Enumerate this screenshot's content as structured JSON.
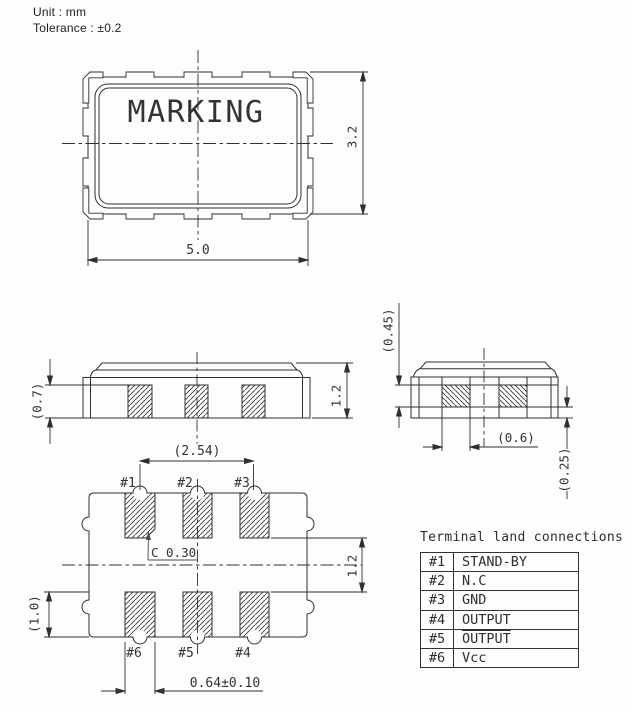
{
  "notes": {
    "unit": "Unit : mm",
    "tolerance": "Tolerance : ±0.2"
  },
  "top_view": {
    "marking": "MARKING",
    "dim_width": "5.0",
    "dim_height": "3.2"
  },
  "front_view": {
    "dim_pad_height": "(0.7)",
    "dim_body_height": "1.2"
  },
  "end_view": {
    "dim_electrode_height": "(0.45)",
    "dim_pad_width": "(0.6)",
    "dim_rim_height": "(0.25)"
  },
  "bottom_view": {
    "dim_pitch": "(2.54)",
    "dim_row_gap": "1.2",
    "dim_pad_length": "(1.0)",
    "chamfer_note": "C 0.30",
    "dim_pad_width": "0.64±0.10",
    "pads": [
      {
        "label": "#1"
      },
      {
        "label": "#2"
      },
      {
        "label": "#3"
      },
      {
        "label": "#4"
      },
      {
        "label": "#5"
      },
      {
        "label": "#6"
      }
    ]
  },
  "table": {
    "title": "Terminal land connections",
    "rows": [
      {
        "pin": "#1",
        "signal": "STAND-BY",
        "overline": false
      },
      {
        "pin": "#2",
        "signal": "N.C",
        "overline": false
      },
      {
        "pin": "#3",
        "signal": "GND",
        "overline": false
      },
      {
        "pin": "#4",
        "signal": "OUTPUT",
        "overline": false
      },
      {
        "pin": "#5",
        "signal": "OUTPUT",
        "overline": true
      },
      {
        "pin": "#6",
        "signal": "Vcc",
        "overline": false
      }
    ]
  },
  "colors": {
    "line": "#2f2f2f",
    "text": "#333333",
    "marking": "#555555"
  }
}
